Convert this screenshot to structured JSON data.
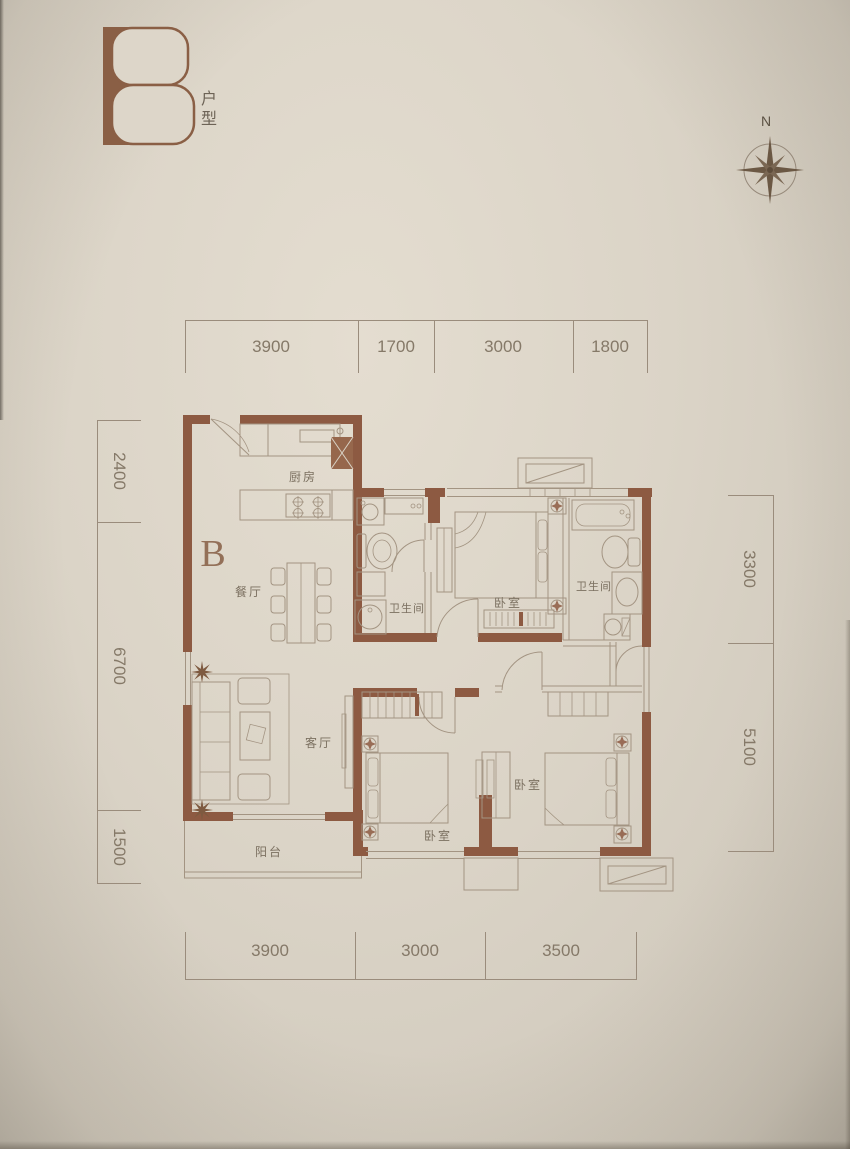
{
  "header": {
    "logo_letter": "B",
    "logo_caption": "户型"
  },
  "compass": {
    "north_label": "N"
  },
  "dimensions": {
    "top": [
      "3900",
      "1700",
      "3000",
      "1800"
    ],
    "bottom": [
      "3900",
      "3000",
      "3500"
    ],
    "left": [
      "2400",
      "6700",
      "1500"
    ],
    "right": [
      "3300",
      "5100"
    ]
  },
  "plan": {
    "unit_label": "B",
    "rooms": {
      "kitchen": "厨房",
      "dining": "餐厅",
      "bath_main": "卫生间",
      "bath_second": "卫生间",
      "bedroom_top": "卧室",
      "bedroom_middle": "卧室",
      "bedroom_right": "卧室",
      "living": "客厅",
      "balcony": "阳台"
    }
  },
  "colors": {
    "wall": "#8d5a42",
    "thin_line": "#a39482",
    "label_text": "#7b7060",
    "dim_text": "#857968",
    "logo": "#8a5f45"
  }
}
